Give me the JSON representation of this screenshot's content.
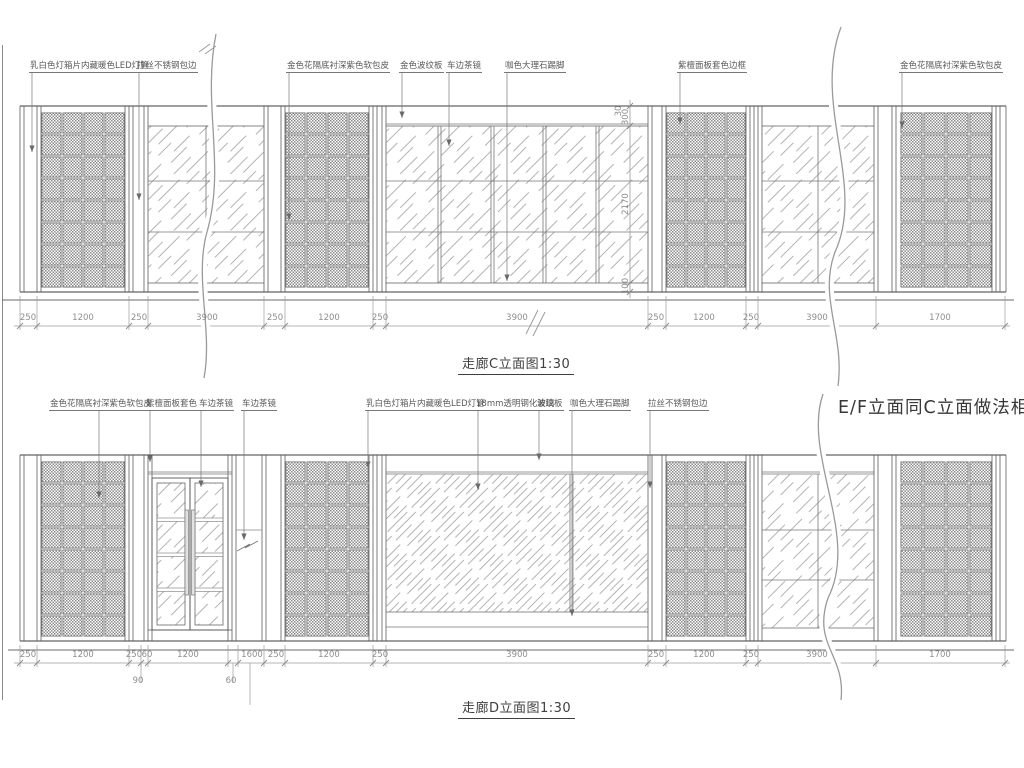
{
  "drawing": {
    "elevation_c": {
      "title": "走廊C立面图1:30",
      "callouts": [
        "乳白色灯箱片内藏暖色LED灯管",
        "拉丝不锈钢包边",
        "金色花隔底衬深紫色软包皮",
        "金色波纹板",
        "车边茶镜",
        "咖色大理石踢脚",
        "紫檀面板套色边框",
        "金色花隔底衬深紫色软包皮"
      ],
      "dims_bottom": [
        "250",
        "1200",
        "250",
        "3900",
        "250",
        "1200",
        "250",
        "3900",
        "250",
        "1200",
        "250",
        "3900",
        "1700"
      ],
      "dims_right": [
        "30",
        "300",
        "2170",
        "100"
      ]
    },
    "elevation_d": {
      "title": "走廊D立面图1:30",
      "callouts": [
        "金色花隔底衬深紫色软包皮",
        "紫檀面板套色",
        "车边茶镜",
        "车边茶镜",
        "乳白色灯箱片内藏暖色LED灯管",
        "18mm透明钢化玻璃",
        "波纹板",
        "咖色大理石踢脚",
        "拉丝不锈钢包边"
      ],
      "dims_bottom": [
        "250",
        "1200",
        "250",
        "60",
        "1200",
        "1600",
        "250",
        "1200",
        "250",
        "3900",
        "250",
        "1200",
        "250",
        "3900",
        "1700"
      ],
      "dims_sub": [
        "90",
        "60"
      ]
    },
    "note_ef": "E/F立面同C立面做法相同",
    "colors": {
      "line": "#555555",
      "dim": "#8e8e8e",
      "text": "#5a5a5a"
    }
  }
}
